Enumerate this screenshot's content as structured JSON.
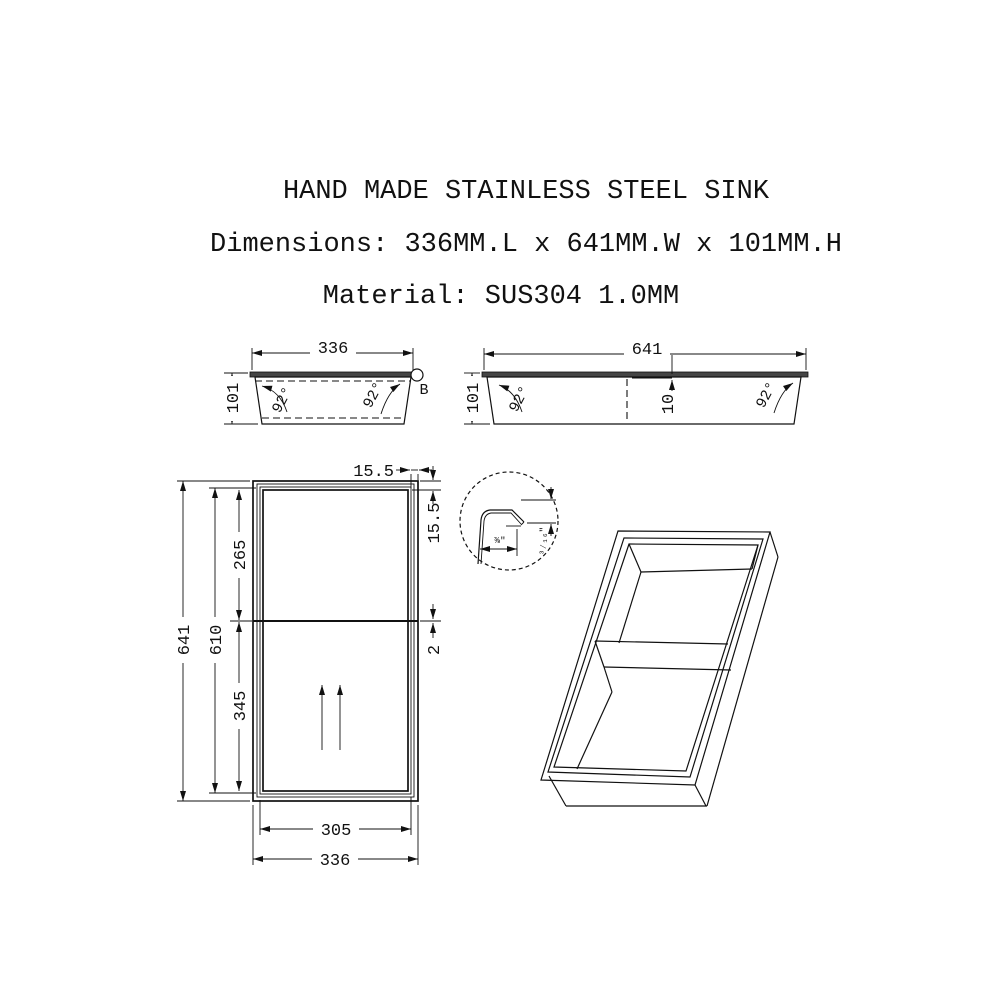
{
  "title": "HAND MADE STAINLESS STEEL SINK",
  "subtitle_dimensions": "Dimensions: 336MM.L x 641MM.W x 101MM.H",
  "subtitle_material": "Material: SUS304 1.0MM",
  "side_view_width": {
    "width": "336",
    "height": "101",
    "angle_left": "92°",
    "angle_right": "92°",
    "detail_marker": "B"
  },
  "side_view_length": {
    "length": "641",
    "height": "101",
    "angle_left": "92°",
    "angle_right": "92°",
    "divider_offset": "10"
  },
  "plan_view": {
    "overall_length": "641",
    "basin_length": "610",
    "bowl_top_length": "265",
    "bowl_bottom_length": "345",
    "basin_width": "305",
    "overall_width": "336",
    "flange_top": "15.5",
    "flange_side": "15.5",
    "divider_thickness": "2"
  },
  "detail_view": {
    "lip_width": "⅜″",
    "lip_drop": "³⁄₁₆″"
  },
  "colors": {
    "line": "#111111",
    "flange_fill": "#454545",
    "background": "#ffffff"
  }
}
